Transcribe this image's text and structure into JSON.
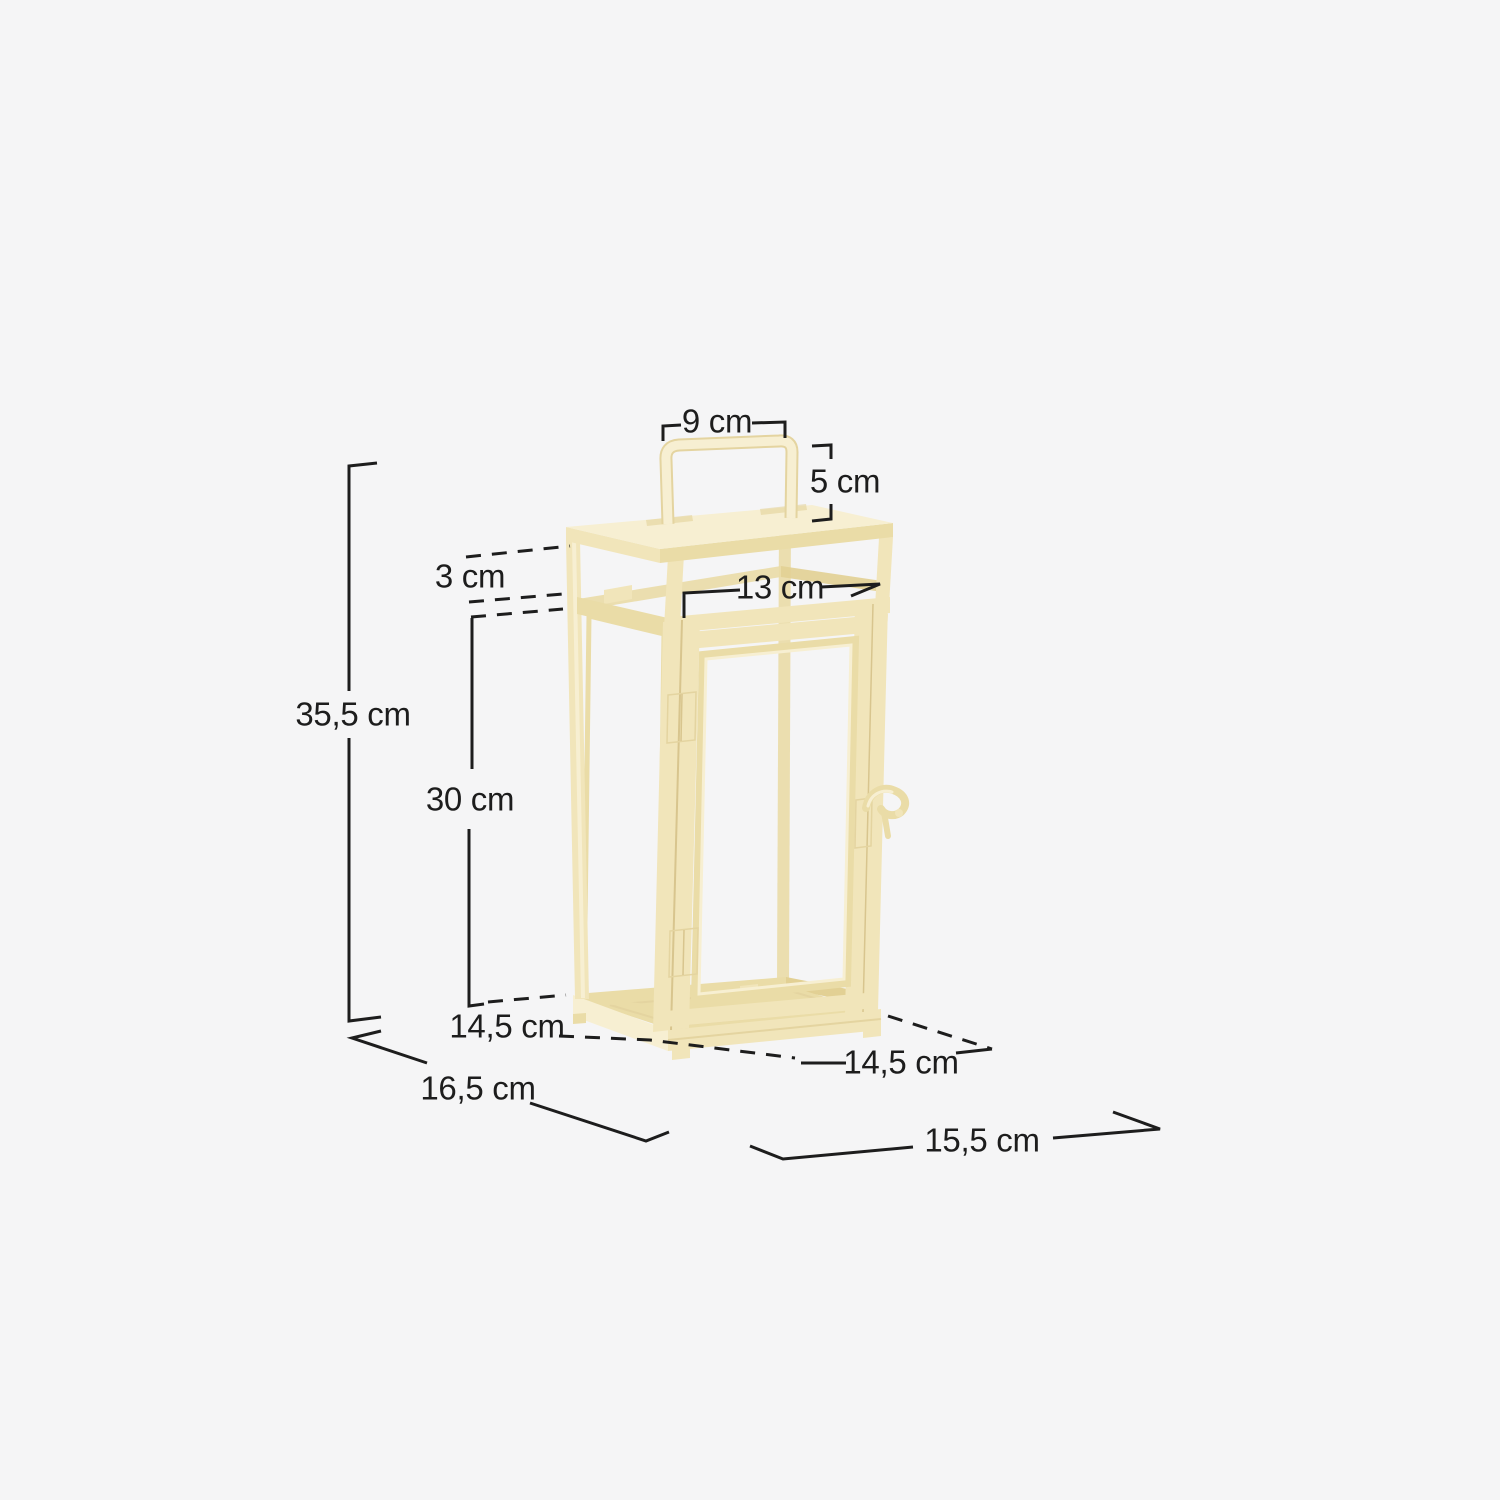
{
  "colors": {
    "background": "#f5f5f6",
    "line": "#1d1d1d",
    "cream_light": "#f7efd2",
    "cream_base": "#f1e5ba",
    "cream_mid": "#eadca7",
    "cream_shadow": "#e2d094",
    "cream_seam": "#d8c58e",
    "cream_edge": "#e4d4a0"
  },
  "dimensions": {
    "handle_width": "9 cm",
    "handle_height": "5 cm",
    "lid_gap_height": "3 cm",
    "top_inner_width": "13 cm",
    "total_height": "35,5 cm",
    "body_height": "30 cm",
    "base_depth": "14,5 cm",
    "base_width": "14,5 cm",
    "overall_depth": "16,5 cm",
    "overall_width": "15,5 cm"
  }
}
